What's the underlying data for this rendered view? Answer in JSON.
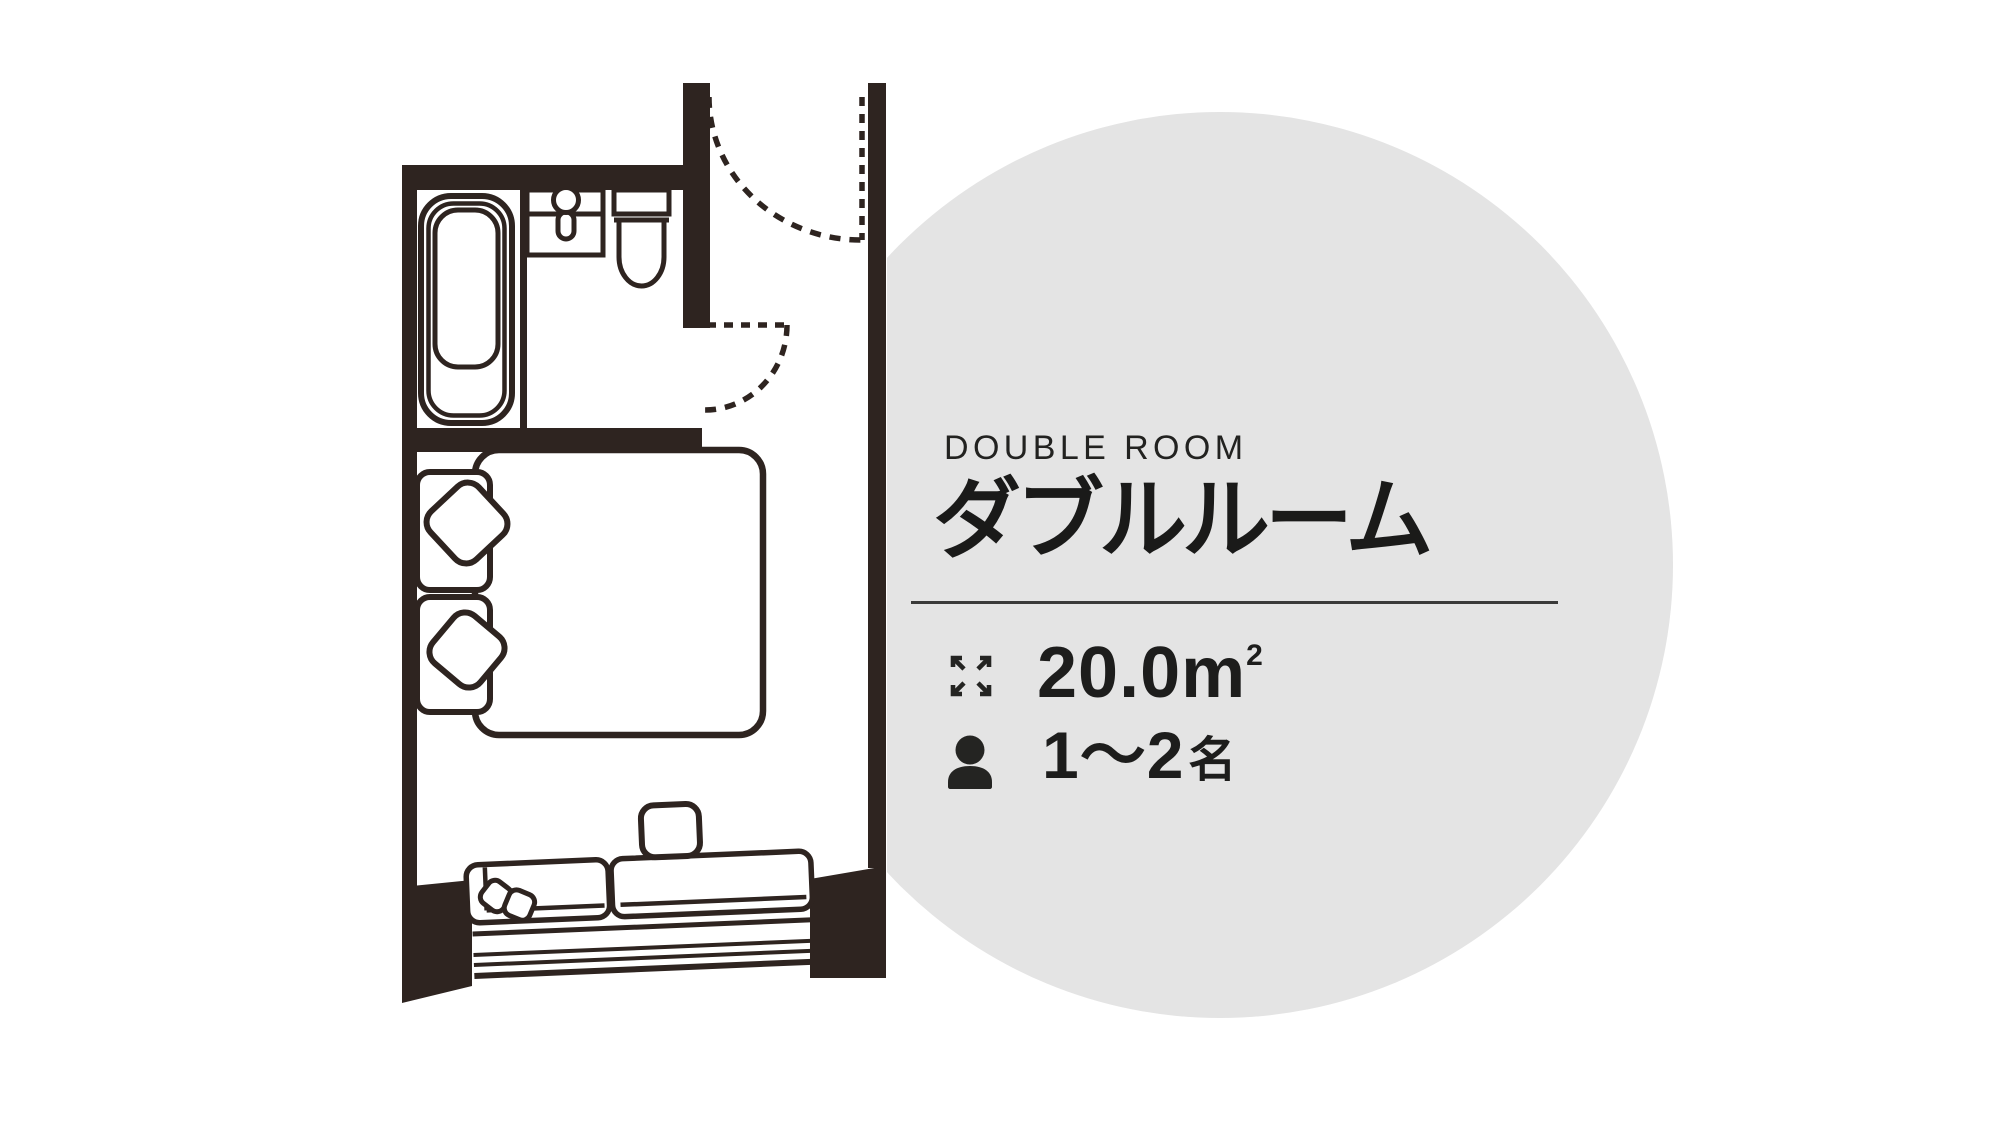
{
  "page": {
    "background_color": "#ffffff"
  },
  "highlight_circle": {
    "color": "#e4e4e4"
  },
  "floor_plan": {
    "ink_color": "#2e2420",
    "elements": [
      "bathtub",
      "vanity-sink",
      "faucet",
      "toilet",
      "entrance-door-swing",
      "bathroom-door-swing",
      "double-bed",
      "headboard",
      "bed-pillows",
      "window-sofa",
      "throw-pillows",
      "side-table",
      "bay-window"
    ]
  },
  "room_info": {
    "category_label": "DOUBLE ROOM",
    "title": "ダブルルーム",
    "area": {
      "icon": "expand-arrows-icon",
      "value": "20.0",
      "unit_base": "m",
      "unit_sup": "2"
    },
    "capacity": {
      "icon": "person-icon",
      "value": "1～2",
      "unit": "名"
    }
  }
}
